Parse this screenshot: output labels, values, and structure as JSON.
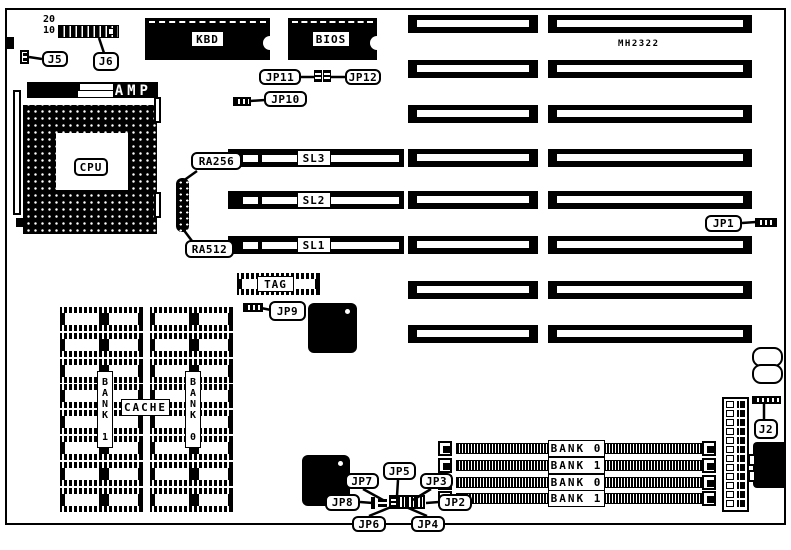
{
  "diagram": {
    "board_id": "MH2322"
  },
  "pin_numbers": {
    "pin20": "20",
    "pin10": "10"
  },
  "components": {
    "kbd": "KBD",
    "bios": "BIOS",
    "cpu": "CPU",
    "amp": "AMP",
    "tag_ram": "TAG",
    "cache": "CACHE",
    "cache_bank_left": "BANK 1",
    "cache_bank_right": "BANK 0"
  },
  "slots": {
    "sl1": "SL1",
    "sl2": "SL2",
    "sl3": "SL3"
  },
  "connectors": {
    "j2": "J2",
    "j5": "J5",
    "j6": "J6",
    "jp1": "JP1",
    "jp2": "JP2",
    "jp3": "JP3",
    "jp4": "JP4",
    "jp5": "JP5",
    "jp6": "JP6",
    "jp7": "JP7",
    "jp8": "JP8",
    "jp9": "JP9",
    "jp10": "JP10",
    "jp11": "JP11",
    "jp12": "JP12",
    "ra256": "RA256",
    "ra512": "RA512"
  },
  "memory": {
    "simm_bank_labels": [
      "BANK 0",
      "BANK 1",
      "BANK 0",
      "BANK 1"
    ]
  },
  "colors": {
    "ink": "#000000",
    "paper": "#ffffff"
  }
}
